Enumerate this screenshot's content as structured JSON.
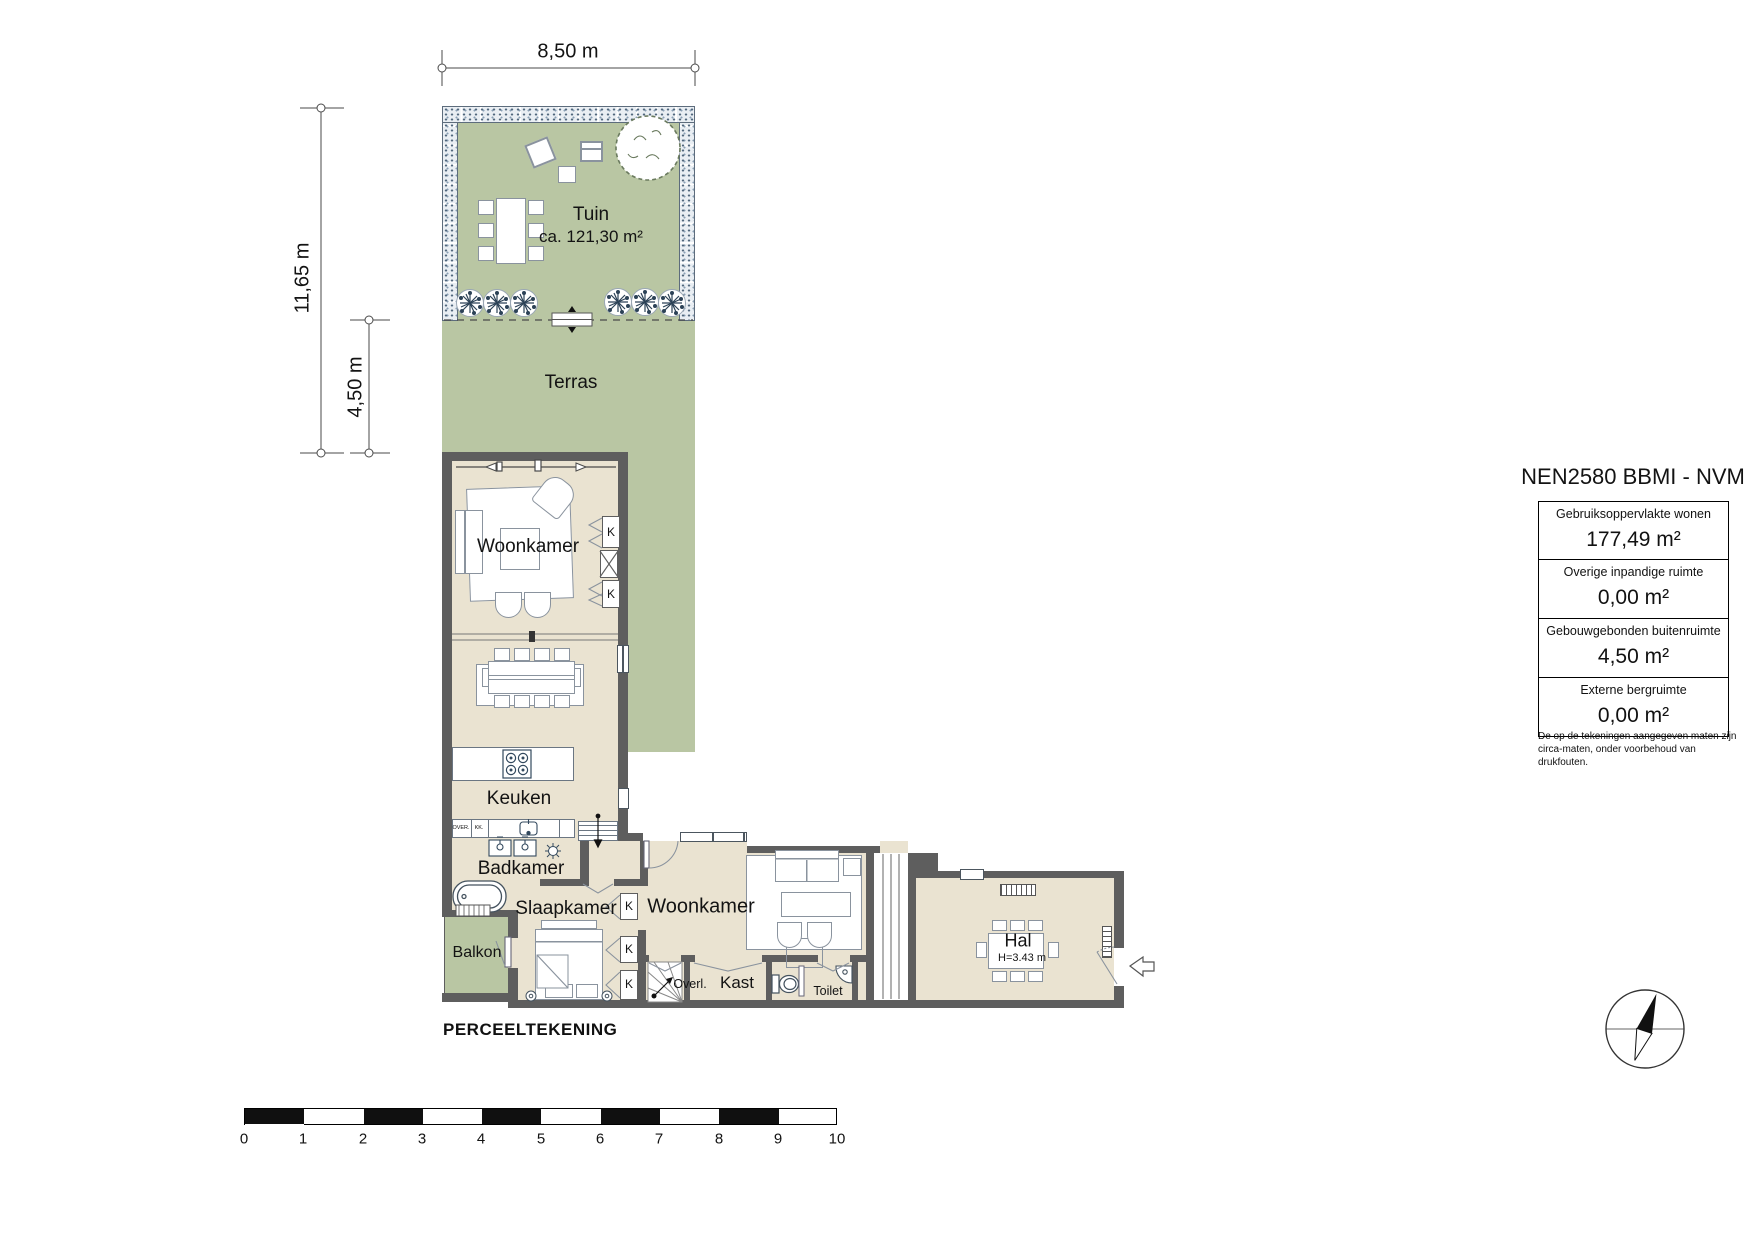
{
  "dimensions": {
    "top_width": "8,50 m",
    "left_height": "11,65 m",
    "terras_depth": "4,50 m"
  },
  "garden": {
    "name": "Tuin",
    "area": "ca. 121,30 m²",
    "terrace": "Terras"
  },
  "rooms": {
    "living1": "Woonkamer",
    "kitchen": "Keuken",
    "bathroom": "Badkamer",
    "bedroom": "Slaapkamer",
    "balcony": "Balkon",
    "living2": "Woonkamer",
    "hall": "Hal",
    "hall_height": "H=3.43 m",
    "landing": "Overl.",
    "closet": "Kast",
    "toilet": "Toilet",
    "wardrobe_k": "K",
    "oven": "OVER.",
    "fridge": "KK."
  },
  "legend": {
    "title": "NEN2580 BBMI - NVM",
    "rows": [
      {
        "label": "Gebruiksoppervlakte wonen",
        "value": "177,49 m²"
      },
      {
        "label": "Overige inpandige ruimte",
        "value": "0,00 m²"
      },
      {
        "label": "Gebouwgebonden buitenruimte",
        "value": "4,50 m²"
      },
      {
        "label": "Externe bergruimte",
        "value": "0,00 m²"
      }
    ],
    "disclaimer_line1": "De op de tekeningen aangegeven maten zijn",
    "disclaimer_line2": "circa-maten, onder voorbehoud van drukfouten."
  },
  "footer": {
    "plot_label": "PERCEELTEKENING",
    "scale_ticks": [
      "0",
      "1",
      "2",
      "3",
      "4",
      "5",
      "6",
      "7",
      "8",
      "9",
      "10"
    ]
  },
  "colors": {
    "garden_green": "#b9c6a3",
    "floor_beige": "#eae3d1",
    "wall_gray": "#5e5e5e"
  }
}
